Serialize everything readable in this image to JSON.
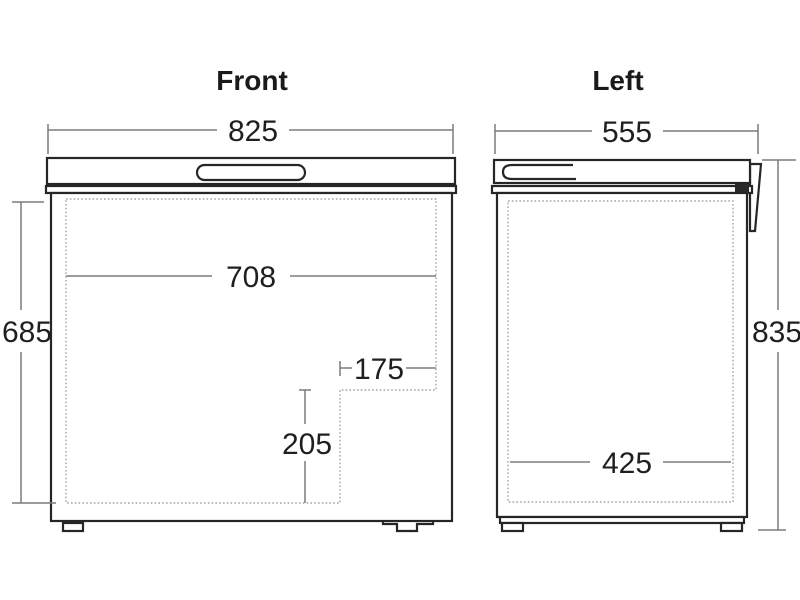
{
  "front": {
    "title": "Front",
    "width_mm": "825",
    "inner_width_mm": "708",
    "height_mm": "685",
    "step_width_mm": "175",
    "step_height_mm": "205"
  },
  "left": {
    "title": "Left",
    "width_mm": "555",
    "height_mm": "835",
    "inner_width_mm": "425"
  },
  "colors": {
    "background": "#ffffff",
    "outline": "#262626",
    "dimension_line": "#7b7b7b",
    "dashed_line": "#a3a3a3",
    "text": "#1a1a1a"
  }
}
